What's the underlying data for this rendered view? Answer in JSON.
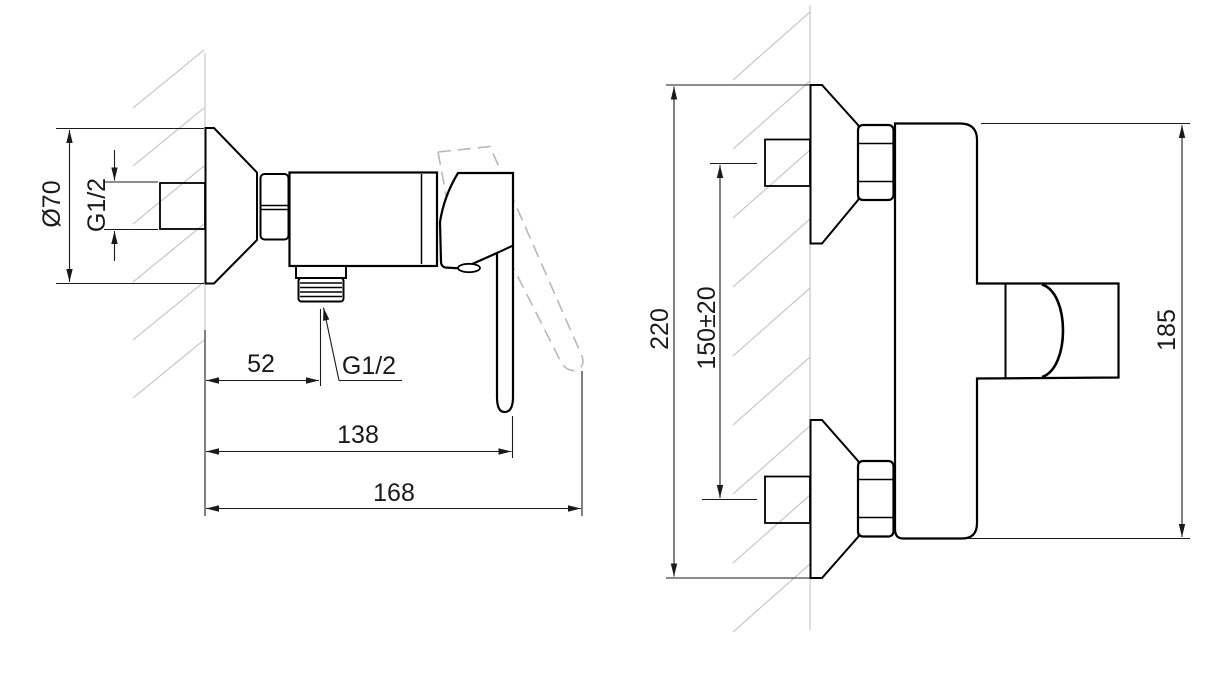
{
  "canvas": {
    "width": 1225,
    "height": 685,
    "background": "#ffffff"
  },
  "drawing": {
    "kind": "technical-dimension-drawing",
    "subject": "wall-mounted single-lever shower mixer, side and front views"
  },
  "style": {
    "outline_color": "#000000",
    "dimension_color": "#1a1a1a",
    "construction_color": "#bcbcbc"
  },
  "views": {
    "side": {
      "name": "side-view",
      "dimensions": {
        "escutcheon_diameter": "Ø70",
        "inlet_thread": "G1/2",
        "outlet_offset": "52",
        "outlet_thread": "G1/2",
        "reach_lever_closed": "138",
        "reach_lever_open": "168"
      }
    },
    "front": {
      "name": "front-view",
      "dimensions": {
        "overall_height": "220",
        "inlet_centres": "150±20",
        "mixer_height": "185"
      }
    }
  }
}
